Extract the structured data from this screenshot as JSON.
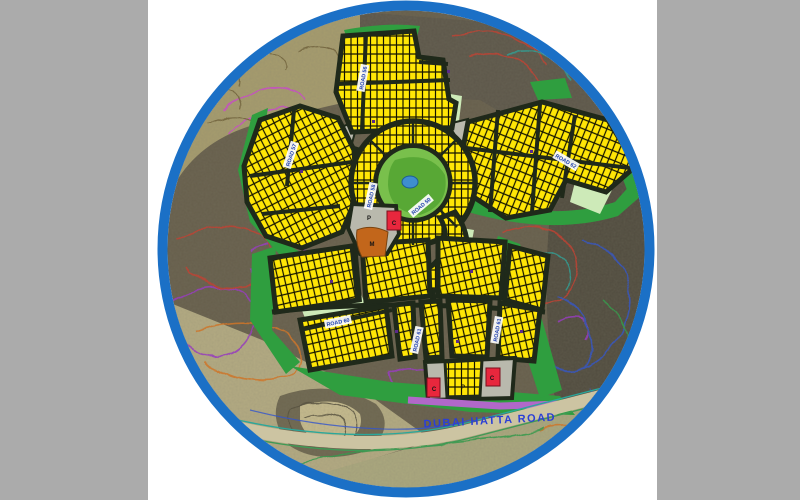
{
  "window": {
    "background_gray": "#ababab",
    "panel_white": "#ffffff"
  },
  "map": {
    "kind": "circular-site-master-plan",
    "ring_color": "#1b70c6",
    "highway_label": "DUBAI HATTA ROAD",
    "highway_label_color": "#2b3fd6",
    "road_labels": [
      {
        "text": "ROAD 56",
        "x": 363,
        "y": 78,
        "rot": -80
      },
      {
        "text": "ROAD 57",
        "x": 291,
        "y": 155,
        "rot": -72
      },
      {
        "text": "ROAD 58",
        "x": 371,
        "y": 196,
        "rot": -78
      },
      {
        "text": "ROAD 50",
        "x": 421,
        "y": 206,
        "rot": -40
      },
      {
        "text": "ROAD 62",
        "x": 566,
        "y": 161,
        "rot": 30
      },
      {
        "text": "ROAD 60",
        "x": 338,
        "y": 322,
        "rot": -12
      },
      {
        "text": "ROAD 61",
        "x": 417,
        "y": 340,
        "rot": -78
      },
      {
        "text": "ROAD 61",
        "x": 497,
        "y": 330,
        "rot": -80
      }
    ],
    "plot_markers": [
      {
        "text": "P",
        "x": 369,
        "y": 220
      },
      {
        "text": "C",
        "x": 394,
        "y": 225
      },
      {
        "text": "M",
        "x": 372,
        "y": 246
      },
      {
        "text": "C",
        "x": 434,
        "y": 391
      },
      {
        "text": "P",
        "x": 463,
        "y": 389
      },
      {
        "text": "C",
        "x": 492,
        "y": 380
      }
    ],
    "legend_colors": {
      "residential_plot_yellow": "#ffe606",
      "park_green": "#58a835",
      "open_space_green": "#2f9e3f",
      "pale_green": "#cdeab8",
      "road_dark": "#1f291a",
      "mosque_brown": "#c2661b",
      "commercial_red": "#e8273d",
      "parking_gray": "#b9b9ad",
      "reserve_strip_purple": "#b168c9",
      "pond_blue": "#3e8ed0"
    }
  }
}
